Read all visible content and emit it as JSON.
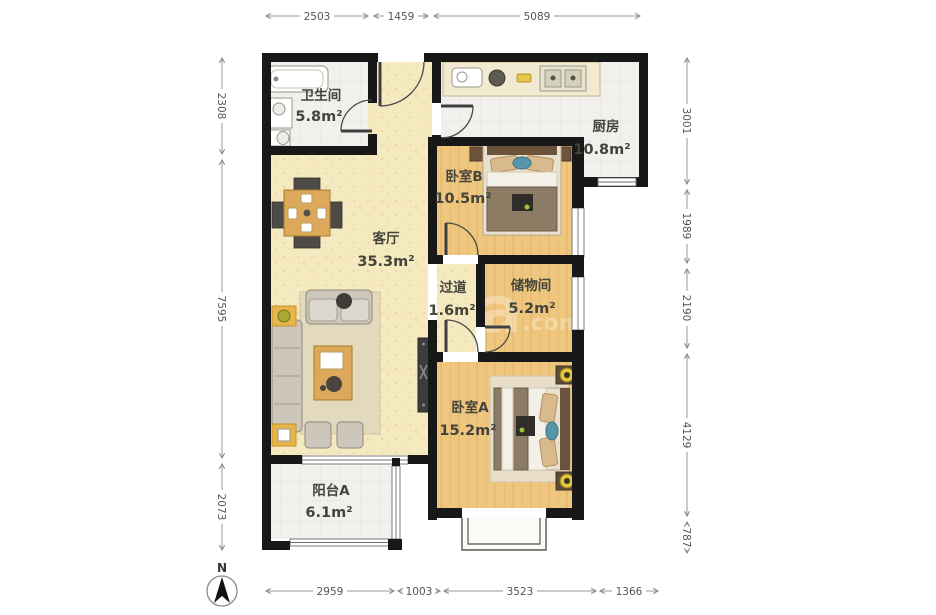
{
  "floor_plan": {
    "rooms": {
      "bathroom": {
        "name": "卫生间",
        "area": "5.8m²"
      },
      "kitchen": {
        "name": "厨房",
        "area": "10.8m²"
      },
      "bedroom_b": {
        "name": "卧室B",
        "area": "10.5m²"
      },
      "living_room": {
        "name": "客厅",
        "area": "35.3m²"
      },
      "hallway": {
        "name": "过道",
        "area": "1.6m²"
      },
      "storage": {
        "name": "储物间",
        "area": "5.2m²"
      },
      "bedroom_a": {
        "name": "卧室A",
        "area": "15.2m²"
      },
      "balcony": {
        "name": "阳台A",
        "area": "6.1m²"
      }
    },
    "dimensions_mm": {
      "top": [
        "2503",
        "1459",
        "5089"
      ],
      "bottom": [
        "2959",
        "1003",
        "3523",
        "1366"
      ],
      "left": [
        "2308",
        "7595",
        "2073"
      ],
      "right": [
        "3001",
        "1989",
        "2190",
        "4129",
        "787"
      ]
    },
    "compass": {
      "north_label": "N"
    },
    "watermark": {
      "main": "a",
      "suffix": ".com"
    },
    "colors": {
      "wall": "#181818",
      "wood_floor": "#eec67e",
      "tile_floor": "#f1f0ec",
      "living_floor": "#f5e9c0",
      "accent_yellow": "#e8b54a"
    }
  }
}
